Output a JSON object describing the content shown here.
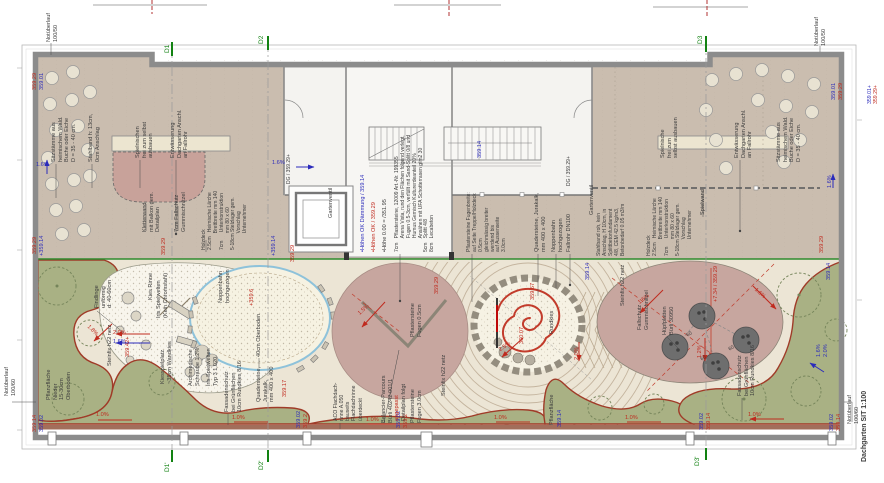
{
  "title": {
    "text": "Dachgarten SIT 1:100"
  },
  "colors": {
    "g": "#3c3c3c",
    "r": "#c02a1e",
    "b": "#2b2bbb",
    "gr": "#128212",
    "terrace": "#cabdaf",
    "playground": "#ece5d5",
    "lawn": "#a9b184",
    "lawn_edge": "#a03b28",
    "mauve": "#c7a69f",
    "wall": "#8c8c8c",
    "sand_edge": "#8ec2da",
    "kies": "#f8f5ec",
    "green_line": "#2e8b2e"
  },
  "legend": {
    "blue": "•Höhen OK Dämmung / 359.14",
    "red": "•Höhen OK / 359.29",
    "zero": "•Höhe 0.00 = /351.95"
  },
  "annotations": [
    {
      "name": "notueberlauf-top-left",
      "text": "Notüberlauf\n100/50",
      "x": 46,
      "y": 42
    },
    {
      "name": "notueberlauf-top-right",
      "text": "Notüberlauf\n100/50",
      "x": 814,
      "y": 46
    },
    {
      "name": "notueberlauf-bottom-left",
      "text": "Notüberlauf\n100/60",
      "x": 4,
      "y": 396
    },
    {
      "name": "notueberlauf-bottom-right",
      "text": "Notüberlauf\n100/60",
      "x": 847,
      "y": 424
    },
    {
      "name": "drawing-title",
      "text": "Dachgarten SIT 1:100",
      "x": 861,
      "y": 462,
      "size": 7,
      "bold": true
    },
    {
      "name": "section-marker-d1",
      "text": "D1",
      "x": 164,
      "y": 53,
      "color": "gr",
      "size": 6.5
    },
    {
      "name": "section-marker-d2",
      "text": "D2",
      "x": 258,
      "y": 44,
      "color": "gr",
      "size": 6.5
    },
    {
      "name": "section-marker-d3",
      "text": "D3",
      "x": 697,
      "y": 44,
      "color": "gr",
      "size": 6.5
    },
    {
      "name": "section-marker-d1p",
      "text": "D1'",
      "x": 164,
      "y": 472,
      "color": "gr",
      "size": 6.5
    },
    {
      "name": "section-marker-d2p",
      "text": "D2'",
      "x": 258,
      "y": 470,
      "color": "gr",
      "size": 6.5
    },
    {
      "name": "section-marker-d3p",
      "text": "D3'",
      "x": 694,
      "y": 466,
      "color": "gr",
      "size": 6.5
    },
    {
      "name": "elev",
      "text": "359.29",
      "x": 32,
      "y": 90,
      "color": "r"
    },
    {
      "name": "elev",
      "text": "359.01",
      "x": 39,
      "y": 90,
      "color": "b"
    },
    {
      "name": "elev",
      "text": "359.01",
      "x": 831,
      "y": 100,
      "color": "b"
    },
    {
      "name": "elev",
      "text": "359.29",
      "x": 838,
      "y": 100,
      "color": "r"
    },
    {
      "name": "elev",
      "text": "359.01+",
      "x": 867,
      "y": 104,
      "color": "b",
      "size": 5.2
    },
    {
      "name": "elev",
      "text": "359.29+",
      "x": 873,
      "y": 104,
      "color": "r",
      "size": 5.2
    },
    {
      "name": "elev",
      "text": "359.29",
      "x": 32,
      "y": 254,
      "color": "r"
    },
    {
      "name": "elev",
      "text": "+359.14",
      "x": 39,
      "y": 256,
      "color": "b"
    },
    {
      "name": "elev",
      "text": "359.29",
      "x": 161,
      "y": 255,
      "color": "r"
    },
    {
      "name": "elev",
      "text": "+359.14",
      "x": 271,
      "y": 256,
      "color": "b"
    },
    {
      "name": "elev",
      "text": "359.29",
      "x": 290,
      "y": 262,
      "color": "r"
    },
    {
      "name": "elev",
      "text": "359.14",
      "x": 477,
      "y": 158,
      "color": "b"
    },
    {
      "name": "elev",
      "text": "359.14",
      "x": 585,
      "y": 280,
      "color": "b"
    },
    {
      "name": "elev",
      "text": "359.29",
      "x": 819,
      "y": 253,
      "color": "r"
    },
    {
      "name": "elev",
      "text": "359.14",
      "x": 826,
      "y": 280,
      "color": "b"
    },
    {
      "name": "elev",
      "text": "359.14",
      "x": 32,
      "y": 432,
      "color": "r"
    },
    {
      "name": "elev",
      "text": "359.02",
      "x": 39,
      "y": 432,
      "color": "b"
    },
    {
      "name": "elev",
      "text": "359.02",
      "x": 296,
      "y": 428,
      "color": "b"
    },
    {
      "name": "elev",
      "text": "359.2",
      "x": 303,
      "y": 428,
      "color": "r"
    },
    {
      "name": "elev",
      "text": "359.02",
      "x": 396,
      "y": 428,
      "color": "b"
    },
    {
      "name": "elev",
      "text": "359.2",
      "x": 403,
      "y": 428,
      "color": "r"
    },
    {
      "name": "pflanzflaeche-bottom",
      "text": "Pflanzfläche",
      "x": 549,
      "y": 425
    },
    {
      "name": "elev",
      "text": "359.14",
      "x": 557,
      "y": 427,
      "color": "b"
    },
    {
      "name": "elev",
      "text": "359.02",
      "x": 699,
      "y": 430,
      "color": "b"
    },
    {
      "name": "elev",
      "text": "359.14",
      "x": 706,
      "y": 430,
      "color": "r"
    },
    {
      "name": "elev",
      "text": "359.02",
      "x": 829,
      "y": 431,
      "color": "b"
    },
    {
      "name": "elev",
      "text": "359.14",
      "x": 836,
      "y": 431,
      "color": "r"
    },
    {
      "name": "slope",
      "text": "1.6%",
      "x": 36,
      "y": 162,
      "rot": 0,
      "color": "b"
    },
    {
      "name": "slope",
      "text": "1.6%",
      "x": 272,
      "y": 160,
      "rot": 0,
      "color": "b"
    },
    {
      "name": "slope",
      "text": "1.6%",
      "x": 827,
      "y": 188,
      "color": "b"
    },
    {
      "name": "slope",
      "text": "2.0%",
      "x": 113,
      "y": 330,
      "rot": 0,
      "color": "r"
    },
    {
      "name": "slope",
      "text": "1.6%",
      "x": 113,
      "y": 339,
      "rot": 0,
      "color": "b"
    },
    {
      "name": "slope",
      "text": "1.8%",
      "x": 90,
      "y": 324,
      "rot": 45,
      "color": "r"
    },
    {
      "name": "slope",
      "text": "1.5%",
      "x": 357,
      "y": 312,
      "rot": -42,
      "color": "r"
    },
    {
      "name": "slope",
      "text": "2.5%",
      "x": 498,
      "y": 348,
      "rot": -35,
      "color": "r"
    },
    {
      "name": "slope",
      "text": "2.0%",
      "x": 574,
      "y": 360,
      "color": "r"
    },
    {
      "name": "slope",
      "text": "1.6%",
      "x": 637,
      "y": 301,
      "rot": -38,
      "color": "r"
    },
    {
      "name": "slope",
      "text": "1.2%",
      "x": 697,
      "y": 358,
      "color": "r"
    },
    {
      "name": "slope",
      "text": "1.6%",
      "x": 757,
      "y": 287,
      "rot": 42,
      "color": "r"
    },
    {
      "name": "slope",
      "text": "1.6%",
      "x": 816,
      "y": 357,
      "color": "b"
    },
    {
      "name": "slope",
      "text": "2.0%",
      "x": 823,
      "y": 357,
      "color": "b"
    },
    {
      "name": "slope",
      "text": "1.0%",
      "x": 96,
      "y": 412,
      "rot": 0,
      "color": "r"
    },
    {
      "name": "slope",
      "text": "1.0%",
      "x": 232,
      "y": 415,
      "rot": 0,
      "color": "r"
    },
    {
      "name": "slope",
      "text": "1.0%",
      "x": 366,
      "y": 417,
      "rot": 0,
      "color": "r"
    },
    {
      "name": "slope",
      "text": "1.0%",
      "x": 494,
      "y": 415,
      "rot": 0,
      "color": "r"
    },
    {
      "name": "slope",
      "text": "1.0%",
      "x": 625,
      "y": 415,
      "rot": 0,
      "color": "r"
    },
    {
      "name": "slope",
      "text": "1.0%",
      "x": 748,
      "y": 412,
      "rot": 0,
      "color": "r"
    },
    {
      "name": "findlinge",
      "text": "Findlinge\nunförmig\nd: 40-60cm",
      "x": 94,
      "y": 308
    },
    {
      "name": "steinfix-1",
      "text": "Steinfix h22 netz",
      "x": 107,
      "y": 366
    },
    {
      "name": "elev",
      "text": "359.42+",
      "x": 125,
      "y": 357,
      "color": "r"
    },
    {
      "name": "kiesspielplatz",
      "text": "Kiesspielplatz\n~35cm Wandkies",
      "x": 160,
      "y": 384
    },
    {
      "name": "archimedische-schraube",
      "text": "Archimedische\nSchraube 1.2%",
      "x": 188,
      "y": 386
    },
    {
      "name": "iris-typ",
      "text": "Iris Spielwelten\nTyp 3 1.020.",
      "x": 206,
      "y": 386
    },
    {
      "name": "kies-rinne",
      "text": "Kies Rinne",
      "x": 148,
      "y": 300
    },
    {
      "name": "iris-spielwelten",
      "text": "Iris Spielwelten\n(Kein Chromstahl)",
      "x": 156,
      "y": 318
    },
    {
      "name": "noppenbahn-1",
      "text": "Noppenbahn\nhochgezogen",
      "x": 218,
      "y": 303
    },
    {
      "name": "elev",
      "text": "+359.6",
      "x": 249,
      "y": 306,
      "color": "r"
    },
    {
      "name": "oberboden",
      "text": "40cm Oberboden",
      "x": 256,
      "y": 357
    },
    {
      "name": "pflanzflaeche-left",
      "text": "Pflanzfläche\nNieder\n15-30cm\nOberboden",
      "x": 46,
      "y": 400
    },
    {
      "name": "fassadenschutz-left",
      "text": "Fassadenschutz\nbei Grünflächen\n10cm Rundkies 8/16",
      "x": 224,
      "y": 412
    },
    {
      "name": "quadersteine-left",
      "text": "Quadersteine,\nJurakalk,\nmm 400 x 400",
      "x": 256,
      "y": 402
    },
    {
      "name": "elev",
      "text": "359.17",
      "x": 282,
      "y": 397,
      "color": "r"
    },
    {
      "name": "aco-rinne",
      "text": "ACO Flachdach-\nrinne A.050\nbauseits\nFlachdachrinne\nüberdeckt",
      "x": 333,
      "y": 421,
      "size": 5.2
    },
    {
      "name": "balancier-parcours",
      "text": "Balancier-Parcours\nBürli 40242-001/1",
      "x": 381,
      "y": 423
    },
    {
      "name": "angepasst",
      "text": "angepasst",
      "x": 394,
      "y": 421,
      "color": "r"
    },
    {
      "name": "detailplan-folgt",
      "text": "Detailplan folgt",
      "x": 401,
      "y": 421
    },
    {
      "name": "pflastersteine-3",
      "text": "Pflastersteine\nFugen 3.0cm",
      "x": 410,
      "y": 423
    },
    {
      "name": "steinfix-2",
      "text": "Steinfix h22 netz",
      "x": 441,
      "y": 396
    },
    {
      "name": "pflastersteine-05",
      "text": "Pflastersteine\nFugen 0.5cm",
      "x": 410,
      "y": 337
    },
    {
      "name": "elev",
      "text": "359.29",
      "x": 434,
      "y": 294,
      "color": "r"
    },
    {
      "name": "elev",
      "text": "360.07",
      "x": 519,
      "y": 344,
      "color": "r"
    },
    {
      "name": "elev",
      "text": "359.67",
      "x": 530,
      "y": 300,
      "color": "r"
    },
    {
      "name": "rundkies",
      "text": "Rundkies",
      "x": 549,
      "y": 334
    },
    {
      "name": "steinfix-3",
      "text": "Steinfix h22 netz",
      "x": 620,
      "y": 306
    },
    {
      "name": "fallschutz-right",
      "text": "Fallschutz\nGummischnitzel",
      "x": 637,
      "y": 330
    },
    {
      "name": "huepfplatten",
      "text": "Hüpfplatten\nBürli 30950",
      "x": 662,
      "y": 335
    },
    {
      "name": "elev",
      "text": "+7.34 / 359.29",
      "x": 713,
      "y": 302,
      "color": "r"
    },
    {
      "name": "fassadenschutz-right",
      "text": "Fassadenschutz\nbei Grünflächen\n10cm Rundkies 8/16",
      "x": 737,
      "y": 396
    },
    {
      "name": "dim-60",
      "text": "60",
      "x": 686,
      "y": 334,
      "rot": -30,
      "size": 5
    },
    {
      "name": "dim-60",
      "text": "60",
      "x": 700,
      "y": 358,
      "rot": -30,
      "size": 5
    },
    {
      "name": "dim-60",
      "text": "60",
      "x": 728,
      "y": 348,
      "rot": -30,
      "size": 5
    },
    {
      "name": "sitzstaemme-left",
      "text": "Sitzstämme aus\nheimischem Wald.\nBuche oder Eiche\nD = 35 - 40 cm.",
      "x": 51,
      "y": 162
    },
    {
      "name": "stahlband-left",
      "text": "Stahlband h: 13cm,\n0cm Anschlag",
      "x": 88,
      "y": 162
    },
    {
      "name": "spielnischen",
      "text": "Spielnischen\nfrei zum selbst\nausbauen",
      "x": 135,
      "y": 158
    },
    {
      "name": "entwaesserung-left",
      "text": "Entwässerung\nDachgarten Anschl.\nan Fallrohr",
      "x": 170,
      "y": 158
    },
    {
      "name": "kletterwand",
      "text": "Kletterwand\nmit Balkon gem.\nDetailplan",
      "x": 142,
      "y": 232
    },
    {
      "name": "fallschutz-left",
      "text": "7cm Fallschutz\nGummischnitzel",
      "x": 174,
      "y": 232
    },
    {
      "name": "holzdeck-left",
      "text": "Holzdeck\n2.5cm   Heimische Lärche\n            Brettbreite mm 140\n7cm      Unterkonstruktion\n            mm 80 x 60\n5-18cm Stelzlager gem.\n            Vorschlag\n            Unternehmer",
      "x": 202,
      "y": 250,
      "size": 5
    },
    {
      "name": "spielnische-right",
      "text": "Spielnische\nfrei zum\nselbst ausbauen",
      "x": 660,
      "y": 158
    },
    {
      "name": "entwaesserung-right",
      "text": "Entwässerung\nDachgarten Anschl.\nan Fallrohr",
      "x": 734,
      "y": 158
    },
    {
      "name": "sitzstaemme-right",
      "text": "Sitzstämme aus\nheimischem Wald.\nBuche oder Eiche\nD = 35 - 40 cm.",
      "x": 776,
      "y": 162
    },
    {
      "name": "stahlband-right",
      "text": "Stahlband roh, kein\nAnschlag, H 10cm, in\nSplittbetonfundament\n4/8, CEM 42.5 kg/m3,\nBetonbedarf 0.05 m3/m",
      "x": 597,
      "y": 256,
      "size": 5
    },
    {
      "name": "holzdeck-right",
      "text": "Holzdeck\n2.5cm   Heimische Lärche\n            Brettbreite mm 140\n7cm      Unterkonstruktion\n            mm 80 x 60\n5-18cm Stelzlager gem.\n            Vorschlag\n            Unternehmer",
      "x": 647,
      "y": 256,
      "size": 5
    },
    {
      "name": "spielwand",
      "text": "Spielwand",
      "x": 700,
      "y": 215
    },
    {
      "name": "gartenventil-left",
      "text": "Gartenventil",
      "x": 328,
      "y": 218
    },
    {
      "name": "gartenventil-right",
      "text": "Gartenventil",
      "x": 589,
      "y": 215
    },
    {
      "name": "dg-mark",
      "text": "DG / 359.29+",
      "x": 287,
      "y": 184,
      "size": 5
    },
    {
      "name": "dg-mark",
      "text": "DG / 359.29+",
      "x": 567,
      "y": 186,
      "size": 5
    },
    {
      "name": "hoehen-ok-daemmung",
      "text": "•Höhen OK Dämmung / 359.14",
      "x": 360,
      "y": 252,
      "color": "b"
    },
    {
      "name": "hoehen-ok",
      "text": "•Höhen OK / 359.29",
      "x": 371,
      "y": 252,
      "color": "r"
    },
    {
      "name": "hoehe-null",
      "text": "•Höhe 0.00 = /351.95",
      "x": 382,
      "y": 252
    },
    {
      "name": "belag-aufbau",
      "text": "7cm   Pflastersteine, 12009 Art.-Nr. 199355\n          Arena Vista, rund den Flächen folgend verlegt,\n          Fugen 0.5-3cm, verfüllt mit Sand-Splitt 0/8 und\n          Humus Gemisch Kulturerdeanteil 20%\n          Ansähen mit UFA Schotterrasen g/m2 30\n5cm   Splitt 4/8\n8cm   Lecabeton",
      "x": 395,
      "y": 252,
      "size": 5
    },
    {
      "name": "fugenbreite",
      "text": "Pflastersteine Fugenbreite:\nauf Seite Treppe/Holzdeck\n0.5cm\ngleichmässig breiter\nwerdend bis\nauf Aussenseite\n3.0cm",
      "x": 467,
      "y": 252,
      "size": 5
    },
    {
      "name": "quadersteine-center",
      "text": "Quadersteine, Jurakalk,\nmm 400 x 400",
      "x": 534,
      "y": 252
    },
    {
      "name": "noppenbahn-2",
      "text": "Noppenbahn\nhochgezogen",
      "x": 551,
      "y": 252
    },
    {
      "name": "fallrohr",
      "text": "Fallrohr DN100",
      "x": 566,
      "y": 252
    }
  ]
}
